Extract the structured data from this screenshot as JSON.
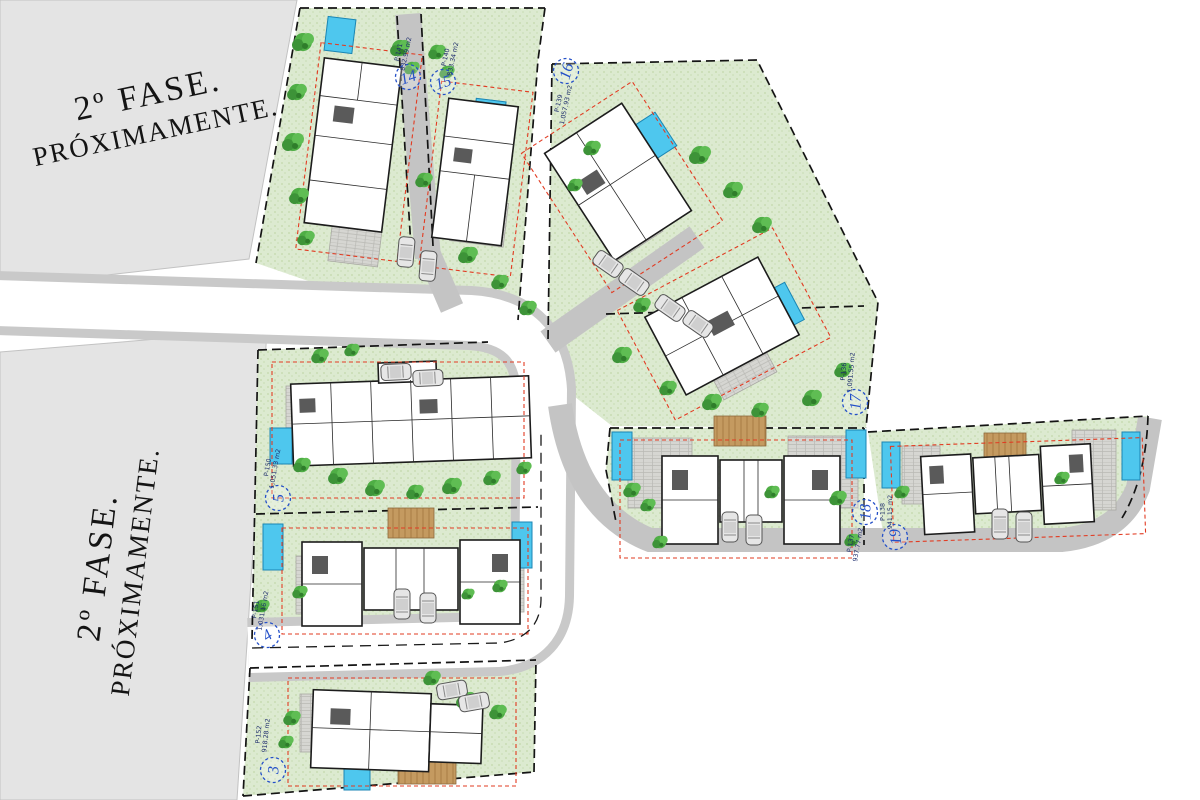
{
  "phase_areas": [
    {
      "id": "top-left",
      "line1": "2º FASE.",
      "line2": "PRÓXIMAMENTE."
    },
    {
      "id": "bottom-left",
      "line1": "2º FASE.",
      "line2": "PRÓXIMAMENTE."
    }
  ],
  "plots": [
    {
      "number": "3",
      "ref": "P-152",
      "area": "918.28 m2"
    },
    {
      "number": "4",
      "ref": "P-151",
      "area": "1,031.16 m2"
    },
    {
      "number": "5",
      "ref": "P-150",
      "area": "1,051.33 m2"
    },
    {
      "number": "14",
      "ref": "P-141",
      "area": "832.99 m2"
    },
    {
      "number": "15",
      "ref": "P-140",
      "area": "833.34 m2"
    },
    {
      "number": "16",
      "ref": "P-139",
      "area": "1,057.93 m2"
    },
    {
      "number": "17",
      "ref": "P-136",
      "area": "1,091.55 m2"
    },
    {
      "number": "18",
      "ref": "P-137",
      "area": "937.77 m2"
    },
    {
      "number": "19",
      "ref": "P-138",
      "area": "941.15 m2"
    }
  ],
  "colors": {
    "accent_blue": "#2450c8",
    "plot_green": "#dcead0",
    "tree_green": "#4fae45",
    "pool_blue": "#4ec7ee",
    "road_gray": "#c4c4c4",
    "phase_gray": "#e4e4e4",
    "setback_red": "#e23b22"
  }
}
